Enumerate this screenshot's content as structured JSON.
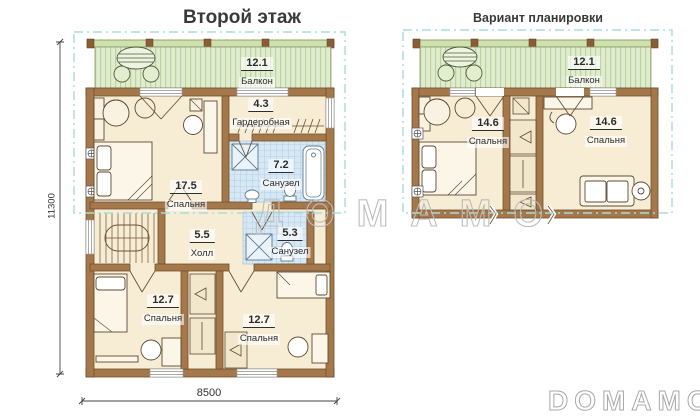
{
  "left_plan": {
    "title": "Второй этаж",
    "dim_width": "8500",
    "dim_height": "11300",
    "rooms": {
      "balcony": {
        "area": "12.1",
        "name": "Балкон"
      },
      "wardrobe": {
        "area": "4.3",
        "name": "Гардеробная"
      },
      "bath_top": {
        "area": "7.2",
        "name": "Санузел"
      },
      "bedroom_main": {
        "area": "17.5",
        "name": "Спальня"
      },
      "hall": {
        "area": "5.5",
        "name": "Холл"
      },
      "bath_bottom": {
        "area": "5.3",
        "name": "Санузел"
      },
      "bedroom_left": {
        "area": "12.7",
        "name": "Спальня"
      },
      "bedroom_right": {
        "area": "12.7",
        "name": "Спальня"
      }
    }
  },
  "right_plan": {
    "title": "Вариант планировки",
    "rooms": {
      "balcony": {
        "area": "12.1",
        "name": "Балкон"
      },
      "bedroom_left": {
        "area": "14.6",
        "name": "Спальня"
      },
      "bedroom_right": {
        "area": "14.6",
        "name": "Спальня"
      }
    }
  },
  "watermarks": {
    "center": "ДОМАМО",
    "corner": "DOMAMO"
  },
  "colors": {
    "wall": "#a5784b",
    "floor": "#f7ecd4",
    "balcony_deck": "#e0ecd0",
    "bath_tile": "#d6e8f4",
    "dashed_outline": "#a8dcdd",
    "text": "#2d2d2d"
  }
}
